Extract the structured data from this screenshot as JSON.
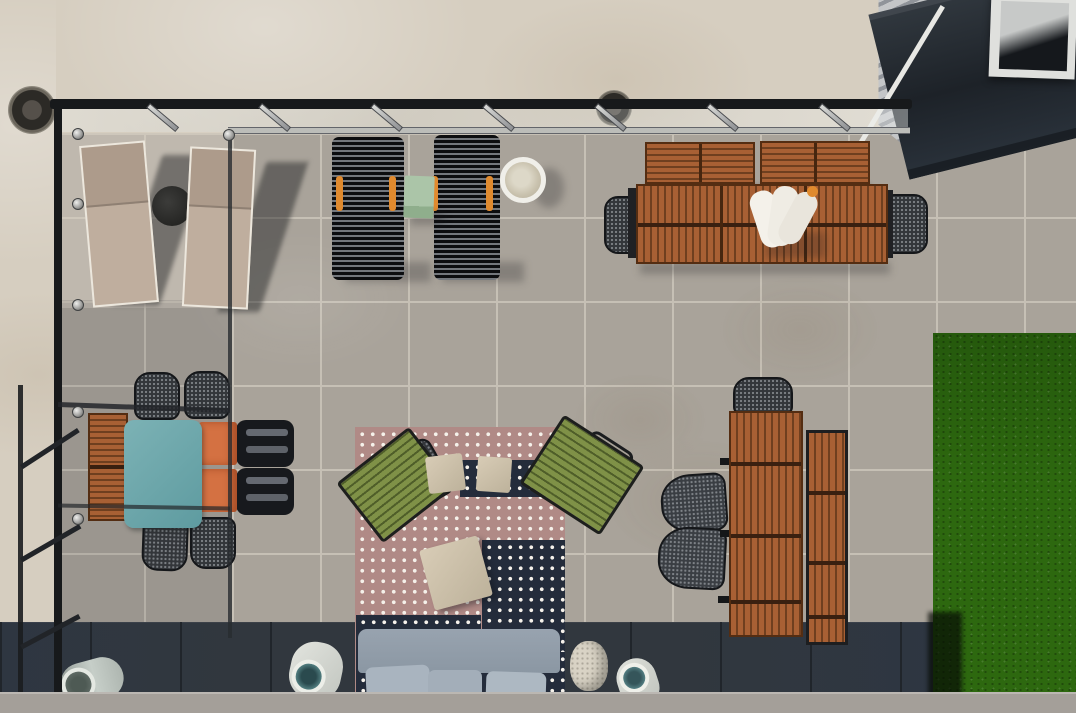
{
  "scene": {
    "type": "aerial-photograph",
    "description": "Top-down aerial view of a rooftop terrace: glass pergola with black frame, two beige sun loungers, two black wire loungers with orange handles, mint cube side table, white round planter, wooden dining table with towels and benches, teal table with mesh and orange chairs, pink dotted rug with green lounge chairs and beige cushions, long wooden table with bench, grey outdoor sofa with cushions, cylindrical poufs, grey stone pavers, dark tile border, artificial grass strip and a building corner with metal siding and skylight."
  },
  "palette": {
    "concrete": "#d6cec0",
    "paver": "#a9a39a",
    "paver_grout": "#c6c0b5",
    "dark_tile": "#31373e",
    "dark_tile_grout": "#20252b",
    "bottom_band": "#a49f99",
    "grass": "#2d680f",
    "pergola_black": "#17191b",
    "silver": "#bcbdb9",
    "wood": "#a86034",
    "wood_dark": "#6f3f1f",
    "wood_edge": "#542d12",
    "teal_table": "#6caab0",
    "orange_chair": "#d47142",
    "orange_accent": "#e08a2e",
    "mint_table": "#abc5a8",
    "rug_pink": "#b08a86",
    "rug_navy": "#242c3b",
    "rug_dot": "#f5f1ea",
    "cushion_beige": "#cfc3ad",
    "green_chair": "#7f9147",
    "green_chair_dark": "#4f5e29",
    "sofa_grey": "#98a3af",
    "pillow_grey": "#a9b4bf",
    "lounger_beige": "#bfae9e",
    "lounger_frame": "#ece7dd",
    "mesh_dark": "#33363a",
    "white": "#f0efe9",
    "siding": "#b9bcbe",
    "awning": "#262c33"
  },
  "objects": [
    {
      "name": "glass-pergola",
      "label": "Glass pergola canopy and black frame"
    },
    {
      "name": "sun-loungers-beige",
      "label": "Two beige sun loungers with round side table"
    },
    {
      "name": "sun-loungers-black",
      "label": "Two black wire sun loungers with orange handles"
    },
    {
      "name": "mint-side-table",
      "label": "Mint green cube side table"
    },
    {
      "name": "round-planter",
      "label": "White round planter"
    },
    {
      "name": "wood-dining-set-top",
      "label": "Wooden dining table with towels, two benches and two mesh chairs"
    },
    {
      "name": "teal-dining-set",
      "label": "Teal table with four mesh chairs, two orange chairs and wooden bench"
    },
    {
      "name": "pink-dotted-rug",
      "label": "Pink and navy dotted rug with green lounge chairs and beige cushions"
    },
    {
      "name": "wood-table-right",
      "label": "Long wooden table with bench and three mesh chairs"
    },
    {
      "name": "grey-sofa",
      "label": "Grey outdoor sofa with three cushions"
    },
    {
      "name": "cylinder-poufs",
      "label": "Cylindrical outdoor poufs and speckled stool"
    },
    {
      "name": "artificial-grass",
      "label": "Artificial grass strip"
    },
    {
      "name": "building-skylight",
      "label": "Building corner with metal siding, dark awning and skylight"
    },
    {
      "name": "drains",
      "label": "Round roof drains"
    }
  ]
}
